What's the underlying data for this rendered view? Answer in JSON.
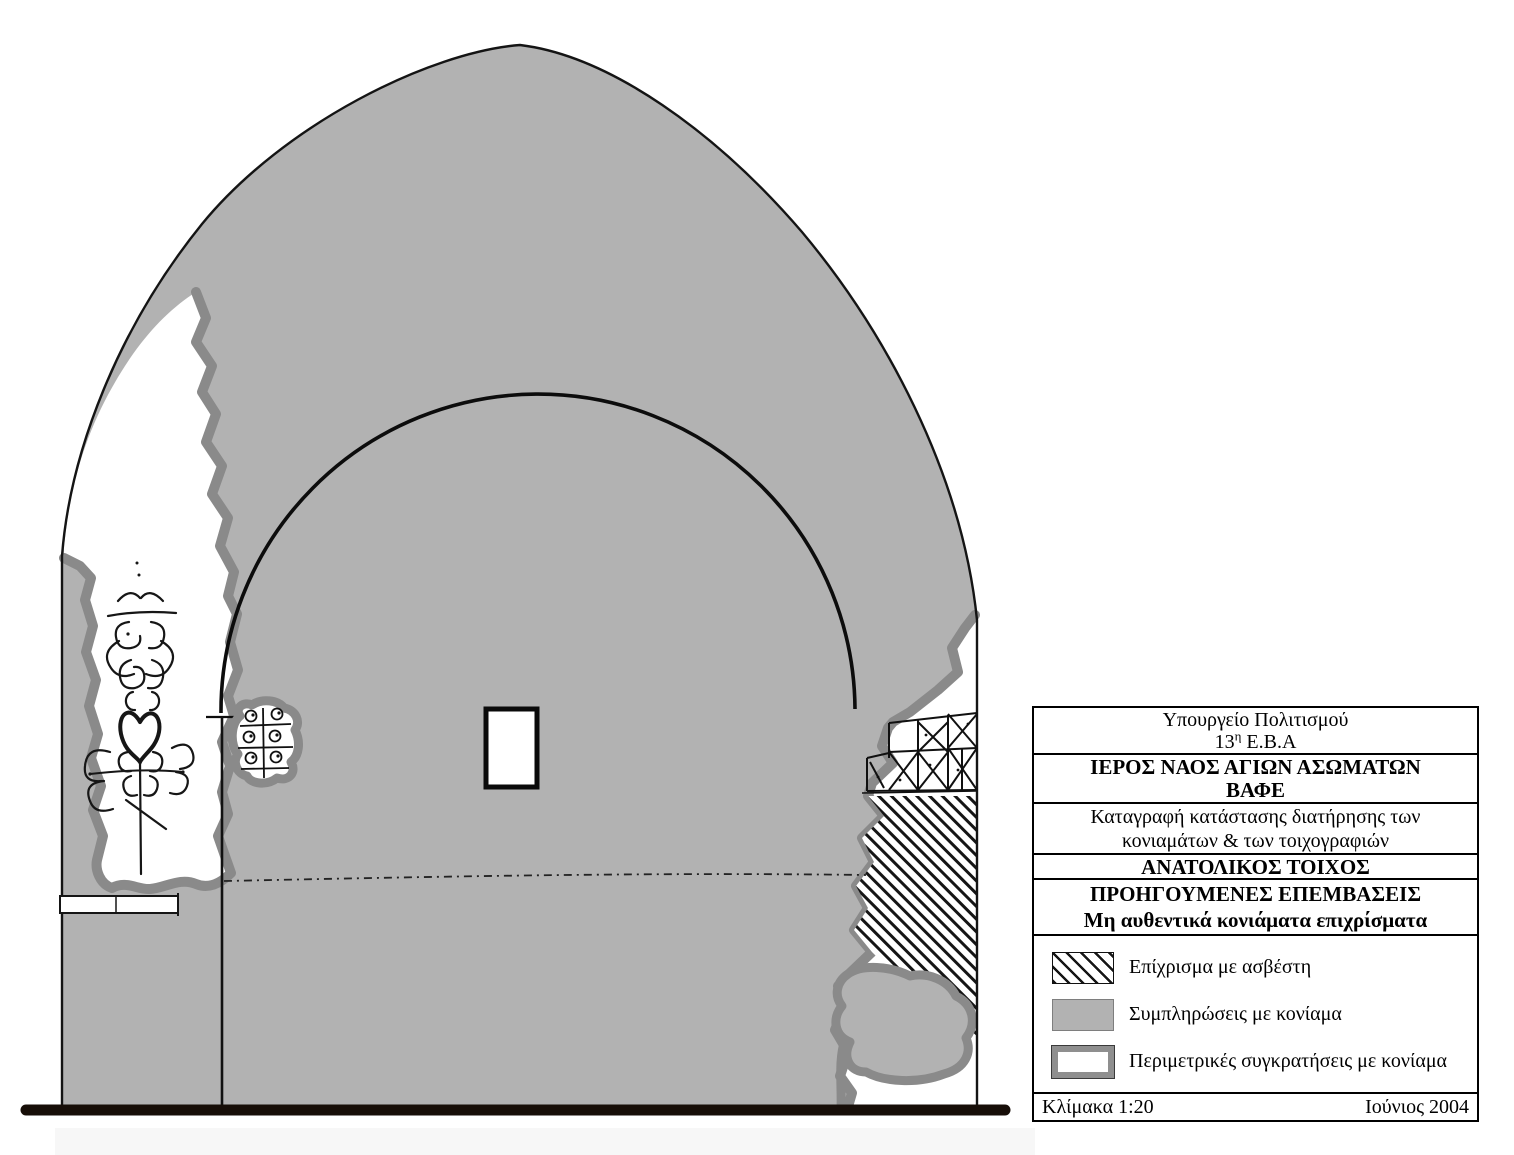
{
  "title_block": {
    "ministry": "Υπουργείο Πολιτισμού",
    "ephorate": {
      "pre": "13",
      "sup": "η",
      "post": " Ε.Β.Α"
    },
    "church": "ΙΕΡΟΣ ΝΑΟΣ ΑΓΙΩΝ ΑΣΩΜΑΤΩΝ",
    "location": "ΒΑΦΕ",
    "description_line1": "Καταγραφή κατάστασης διατήρησης των",
    "description_line2": "κονιαμάτων & των τοιχογραφιών",
    "wall_name": "ΑΝΑΤΟΛΙΚΟΣ ΤΟΙΧΟΣ",
    "section_line1": "ΠΡΟΗΓΟΥΜΕΝΕΣ ΕΠΕΜΒΑΣΕΙΣ",
    "section_line2": "Μη αυθεντικά κονιάματα επιχρίσματα"
  },
  "legend": {
    "items": [
      {
        "swatch": "lime-plaster-hatch-swatch",
        "label": "Επίχρισμα με ασβέστη"
      },
      {
        "swatch": "mortar-fill-gray-swatch",
        "label": "Συμπληρώσεις με κονίαμα"
      },
      {
        "swatch": "perimeter-retention-outline-swatch",
        "label": "Περιμετρικές συγκρατήσεις με κονίαμα"
      }
    ]
  },
  "footer": {
    "scale": "Κλίμακα 1:20",
    "date": "Ιούνιος 2004"
  },
  "colors": {
    "wall_gray": "#b2b2b2",
    "boundary_gray": "#8a8a8a",
    "line_black": "#111111",
    "ground_dark": "#170e08"
  }
}
